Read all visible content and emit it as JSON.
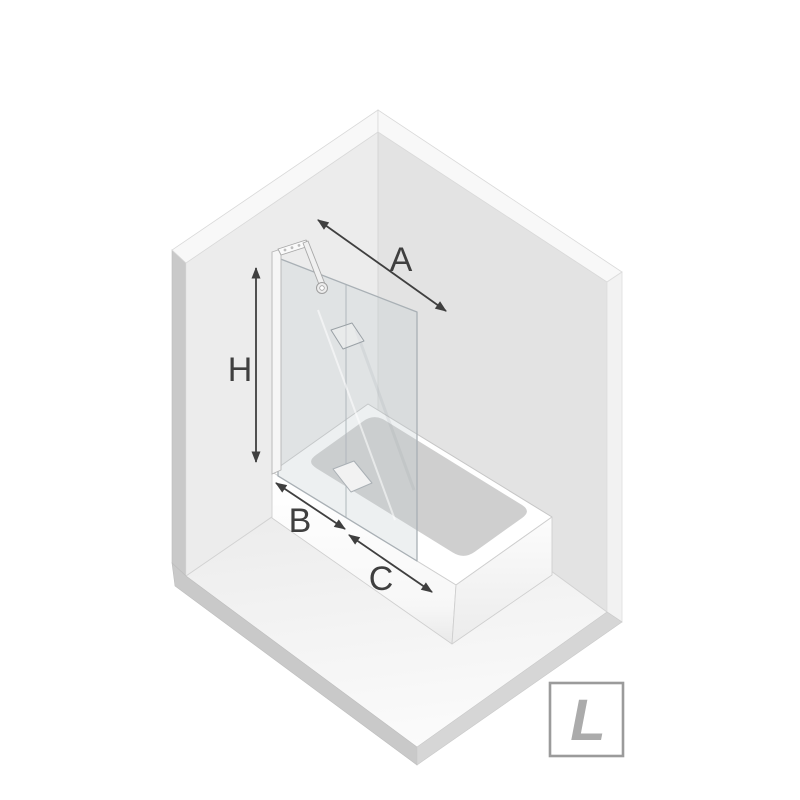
{
  "dimension_labels": {
    "a": "A",
    "h": "H",
    "b": "B",
    "c": "C"
  },
  "orientation_badge": {
    "letter": "L"
  },
  "colors": {
    "background": "#ffffff",
    "wall_left": "#ececec",
    "wall_right": "#e3e3e3",
    "wall_top_edge": "#f8f8f8",
    "wall_side_edge_left": "#c9c9c9",
    "wall_side_edge_right": "#f2f2f2",
    "floor_near": "#fbfbfb",
    "floor_far": "#e9e9e9",
    "floor_edge_left": "#c9c9c9",
    "floor_edge_right": "#d6d6d6",
    "tub_white": "#ffffff",
    "basin_gray": "#cfcfcf",
    "glass_stroke": "#a9b0b5",
    "hardware_gray": "#a8a8a8",
    "arrow": "#3f3f3f",
    "badge_border": "#9b9b9b",
    "badge_letter": "#ababab"
  }
}
